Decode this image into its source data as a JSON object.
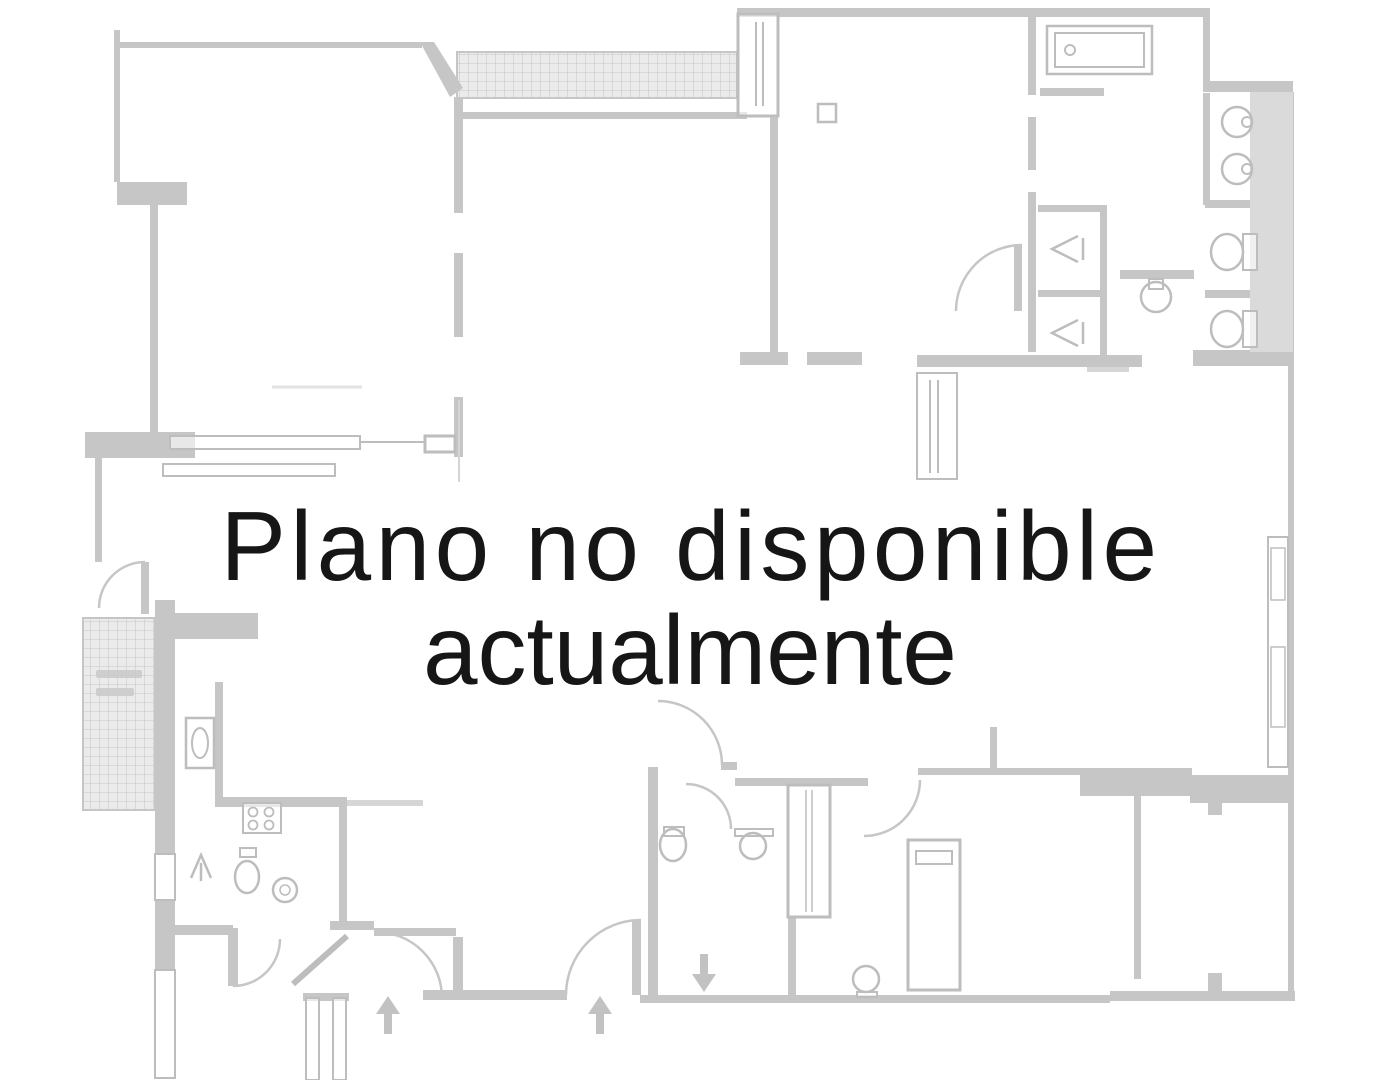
{
  "overlay": {
    "line1": "Plano no disponible",
    "line2": "actualmente",
    "font_size": 98,
    "line1_x": 691,
    "line1_y": 580,
    "line1_spacing": 4.5,
    "line2_x": 690,
    "line2_y": 684,
    "line2_spacing": 0,
    "color": "#161616"
  },
  "floorplan": {
    "colors": {
      "wall": "#c6c6c6",
      "wall_light": "#d6d6d6",
      "band_fill": "#dadada",
      "fixture": "#bdbdbd",
      "hatch_line": "#c6c6c6",
      "hatch_bg": "#ebebeb",
      "arrow": "#c2c2c2",
      "label_mark": "#c9c9c9"
    },
    "hatches": [
      [
        457,
        52,
        280,
        46
      ],
      [
        83,
        618,
        72,
        192
      ]
    ],
    "walls": [
      [
        114,
        30,
        6,
        152
      ],
      [
        120,
        42,
        302,
        6
      ],
      [
        457,
        112,
        290,
        7
      ],
      [
        770,
        117,
        8,
        245
      ],
      [
        454,
        97,
        9,
        116
      ],
      [
        454,
        253,
        9,
        84
      ],
      [
        454,
        397,
        9,
        60
      ],
      [
        117,
        182,
        70,
        23
      ],
      [
        150,
        205,
        8,
        228
      ],
      [
        85,
        432,
        110,
        26
      ],
      [
        95,
        458,
        7,
        104
      ],
      [
        141,
        562,
        8,
        52
      ],
      [
        158,
        613,
        100,
        26
      ],
      [
        155,
        600,
        20,
        254
      ],
      [
        155,
        900,
        20,
        70
      ],
      [
        215,
        682,
        8,
        116
      ],
      [
        215,
        797,
        132,
        10
      ],
      [
        339,
        807,
        8,
        122
      ],
      [
        374,
        928,
        82,
        8
      ],
      [
        453,
        937,
        10,
        55
      ],
      [
        423,
        990,
        144,
        10
      ],
      [
        175,
        925,
        58,
        10
      ],
      [
        228,
        928,
        10,
        58
      ],
      [
        330,
        921,
        44,
        9
      ],
      [
        303,
        993,
        46,
        8
      ],
      [
        648,
        767,
        10,
        230
      ],
      [
        721,
        762,
        16,
        8
      ],
      [
        735,
        778,
        133,
        8
      ],
      [
        788,
        917,
        8,
        80
      ],
      [
        632,
        920,
        9,
        75
      ],
      [
        918,
        768,
        164,
        7
      ],
      [
        1080,
        768,
        112,
        28
      ],
      [
        1190,
        775,
        102,
        28
      ],
      [
        1208,
        801,
        14,
        14
      ],
      [
        1134,
        795,
        7,
        184
      ],
      [
        640,
        995,
        470,
        8
      ],
      [
        1110,
        991,
        185,
        10
      ],
      [
        1208,
        973,
        14,
        20
      ],
      [
        737,
        8,
        470,
        9
      ],
      [
        1203,
        8,
        7,
        80
      ],
      [
        1203,
        81,
        90,
        11
      ],
      [
        1288,
        92,
        6,
        905
      ],
      [
        1193,
        350,
        95,
        16
      ],
      [
        1040,
        88,
        64,
        8
      ],
      [
        1203,
        93,
        7,
        112
      ],
      [
        1120,
        270,
        74,
        9
      ],
      [
        1205,
        200,
        48,
        8
      ],
      [
        1205,
        290,
        48,
        8
      ],
      [
        1028,
        17,
        8,
        78
      ],
      [
        1028,
        117,
        8,
        53
      ],
      [
        1028,
        192,
        8,
        160
      ],
      [
        1038,
        205,
        68,
        7
      ],
      [
        1038,
        290,
        68,
        7
      ],
      [
        1100,
        205,
        7,
        150
      ],
      [
        740,
        352,
        48,
        13
      ],
      [
        807,
        352,
        55,
        13
      ],
      [
        917,
        355,
        225,
        12
      ],
      [
        990,
        727,
        7,
        44
      ],
      [
        1014,
        245,
        8,
        66
      ]
    ],
    "fills": [
      [
        1250,
        92,
        43,
        260,
        "#dadada"
      ],
      [
        1087,
        367,
        42,
        5,
        "#d6d6d6"
      ],
      [
        347,
        800,
        76,
        6,
        "#d6d6d6"
      ]
    ],
    "outlines": [
      [
        738,
        14,
        40,
        102,
        3
      ],
      [
        425,
        436,
        30,
        16,
        3
      ],
      [
        170,
        436,
        190,
        13,
        2
      ],
      [
        163,
        464,
        172,
        12,
        2
      ],
      [
        155,
        854,
        20,
        46,
        2
      ],
      [
        155,
        970,
        20,
        108,
        2
      ],
      [
        788,
        785,
        42,
        132,
        3
      ],
      [
        908,
        840,
        52,
        150,
        3
      ],
      [
        916,
        851,
        36,
        13,
        2
      ],
      [
        917,
        373,
        40,
        106,
        2
      ],
      [
        1268,
        537,
        20,
        230,
        2
      ],
      [
        1271,
        548,
        14,
        52,
        1.5
      ],
      [
        1271,
        647,
        14,
        80,
        1.5
      ],
      [
        818,
        104,
        18,
        18,
        2.5
      ],
      [
        1047,
        26,
        105,
        48,
        2.5
      ],
      [
        1055,
        33,
        89,
        34,
        2
      ],
      [
        186,
        718,
        28,
        50,
        2.5
      ],
      [
        243,
        803,
        38,
        30,
        2
      ],
      [
        240,
        848,
        16,
        9,
        2
      ],
      [
        664,
        827,
        20,
        9,
        2
      ],
      [
        306,
        998,
        13,
        82,
        2
      ],
      [
        333,
        998,
        13,
        82,
        2
      ],
      [
        1243,
        234,
        14,
        36,
        2
      ],
      [
        1243,
        311,
        14,
        36,
        2
      ],
      [
        1149,
        279,
        14,
        10,
        2
      ],
      [
        735,
        829,
        38,
        7,
        2
      ],
      [
        857,
        992,
        20,
        5,
        2
      ]
    ],
    "lines": [
      [
        756,
        22,
        756,
        106,
        2
      ],
      [
        763,
        22,
        763,
        106,
        2
      ],
      [
        360,
        442,
        424,
        442,
        2
      ],
      [
        459,
        400,
        459,
        482,
        2,
        "#d5d5d5"
      ],
      [
        930,
        380,
        930,
        473,
        2
      ],
      [
        938,
        380,
        938,
        473,
        2
      ],
      [
        806,
        790,
        806,
        912,
        1.5
      ],
      [
        812,
        790,
        812,
        912,
        1.5
      ],
      [
        272,
        387,
        362,
        387,
        3,
        "#e2e2e2"
      ],
      [
        201,
        863,
        201,
        881,
        2.5
      ],
      [
        1083,
        238,
        1083,
        260,
        2.5
      ],
      [
        1083,
        322,
        1083,
        344,
        2.5
      ],
      [
        293,
        984,
        347,
        936,
        6
      ]
    ],
    "polygons": [
      "420,42 434,42 463,88 450,97"
    ],
    "arrows": [
      "388,996 376,1014 384,1014 384,1034 392,1034 392,1014 400,1014",
      "600,996 588,1014 596,1014 596,1034 604,1034 604,1014 612,1014",
      "704,992 692,974 700,974 700,954 708,954 708,974 716,974"
    ],
    "circles": [
      [
        1237,
        122,
        15,
        2.5
      ],
      [
        1247,
        122,
        5,
        2
      ],
      [
        1237,
        169,
        15,
        2.5
      ],
      [
        1247,
        169,
        5,
        2
      ],
      [
        1156,
        297,
        15,
        2.5
      ],
      [
        1070,
        50,
        5,
        2
      ],
      [
        285,
        890,
        12,
        2.5
      ],
      [
        285,
        890,
        5,
        1.5
      ],
      [
        753,
        846,
        13,
        2.5
      ],
      [
        866,
        979,
        13,
        2.5
      ]
    ],
    "ellipses": [
      [
        1227,
        252,
        16,
        18,
        2.5
      ],
      [
        1227,
        329,
        16,
        18,
        2.5
      ],
      [
        200,
        743,
        8,
        15,
        2
      ],
      [
        673,
        845,
        13,
        16,
        2.5
      ],
      [
        247,
        877,
        12,
        16,
        2.5
      ]
    ],
    "stove_burners": [
      [
        253,
        812,
        4.5
      ],
      [
        269,
        812,
        4.5
      ],
      [
        253,
        825,
        4.5
      ],
      [
        269,
        825,
        4.5
      ]
    ],
    "paths": [
      "M 145 562 A 46 46 0 0 0 99 608",
      "M 233 986 A 47 47 0 0 0 280 939",
      "M 376 932 A 66 66 0 0 1 442 998",
      "M 641 920 A 75 75 0 0 0 566 995",
      "M 722 765 A 64 64 0 0 0 658 701",
      "M 686 784 A 45 45 0 0 1 731 829",
      "M 920 780 A 56 56 0 0 1 864 836",
      "M 1022 245 A 66 66 0 0 0 956 311"
    ],
    "shower_symbols": [
      "1078,236 1052,249 1078,262",
      "1078,320 1052,333 1078,346",
      "191,878 201,855 211,878"
    ],
    "label_marks": [
      [
        96,
        670,
        46,
        8
      ],
      [
        96,
        688,
        38,
        8
      ]
    ],
    "blobs": [
      [
        563,
        543,
        54,
        37
      ],
      [
        648,
        549,
        48,
        31
      ],
      [
        608,
        585,
        40,
        22
      ]
    ]
  }
}
